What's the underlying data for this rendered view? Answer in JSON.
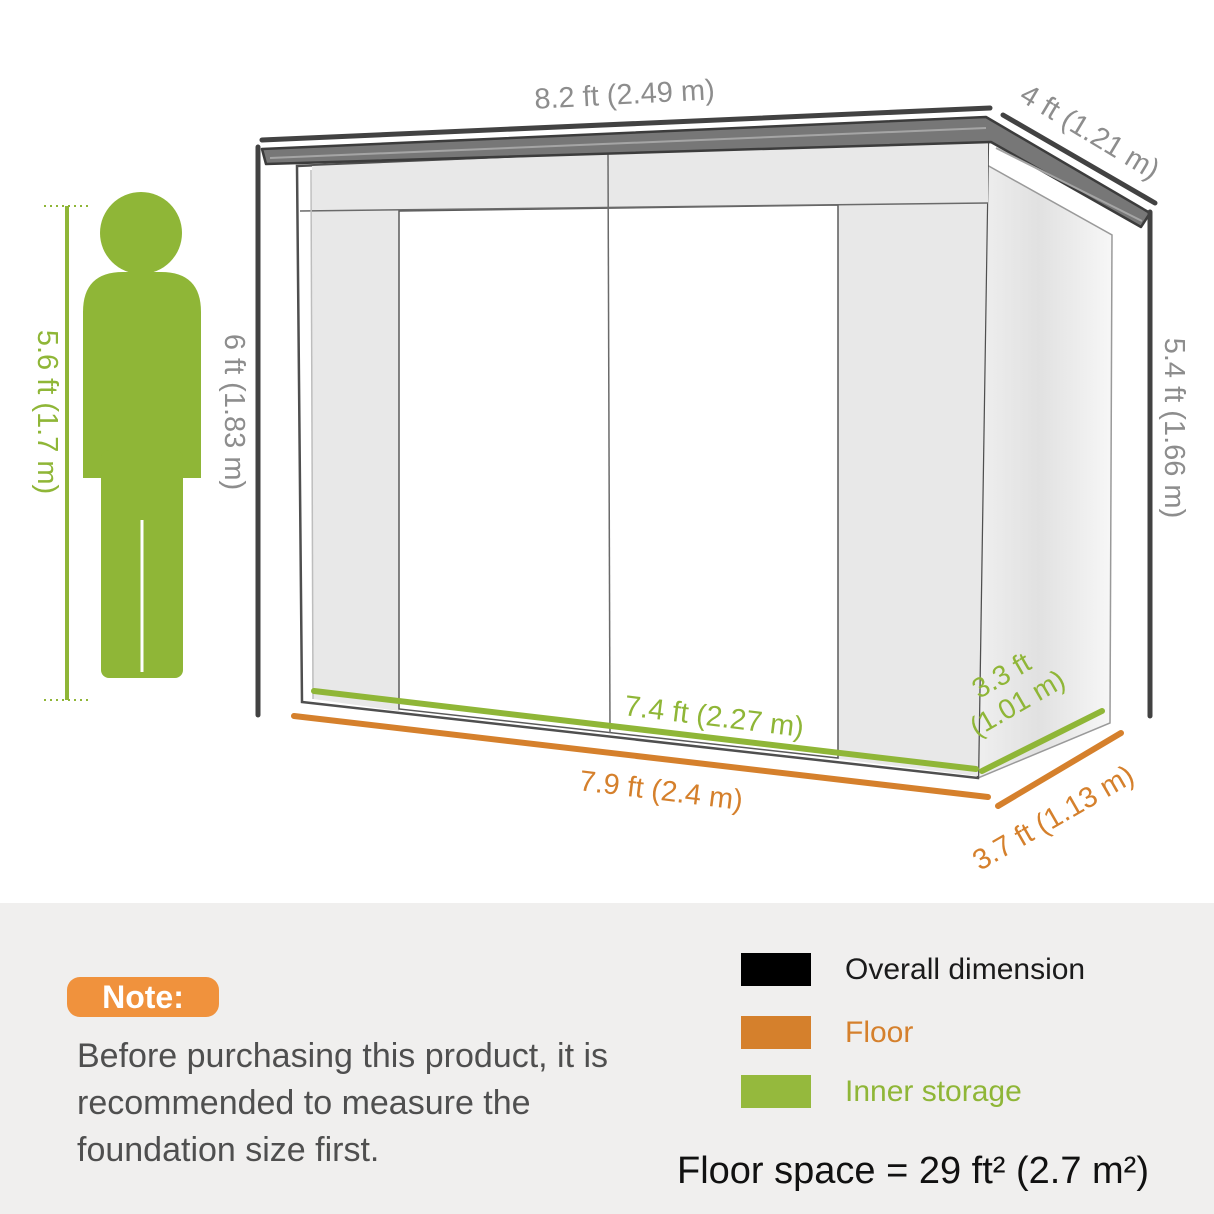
{
  "page": {
    "background_top": "#ffffff",
    "background_panel": "#f0efee"
  },
  "diagram": {
    "dimensions": {
      "roof_width": "8.2 ft (2.49 m)",
      "roof_depth": "4 ft (1.21 m)",
      "height_left": "6 ft (1.83 m)",
      "height_right": "5.4 ft (1.66 m)",
      "person_height": "5.6 ft (1.7 m)",
      "inner_width": "7.4 ft (2.27 m)",
      "inner_depth_line1": "3.3 ft",
      "inner_depth_line2": "(1.01 m)",
      "floor_width": "7.9 ft (2.4 m)",
      "floor_depth": "3.7 ft (1.13 m)"
    },
    "colors": {
      "overall_dimension": "#000000",
      "floor": "#d5802c",
      "inner_storage": "#8fb637",
      "dimension_label_gray": "#8d8d8d"
    }
  },
  "note": {
    "badge_label": "Note:",
    "text": "Before purchasing this product, it is recommended to measure the foundation size first."
  },
  "legend": {
    "items": [
      {
        "label": "Overall dimension",
        "swatch_color": "#000000",
        "text_color": "#1b1b1b"
      },
      {
        "label": "Floor",
        "swatch_color": "#d5802c",
        "text_color": "#d5802c"
      },
      {
        "label": "Inner storage",
        "swatch_color": "#95b93d",
        "text_color": "#8fb637"
      }
    ],
    "floor_space": "Floor space = 29 ft² (2.7 m²)"
  }
}
